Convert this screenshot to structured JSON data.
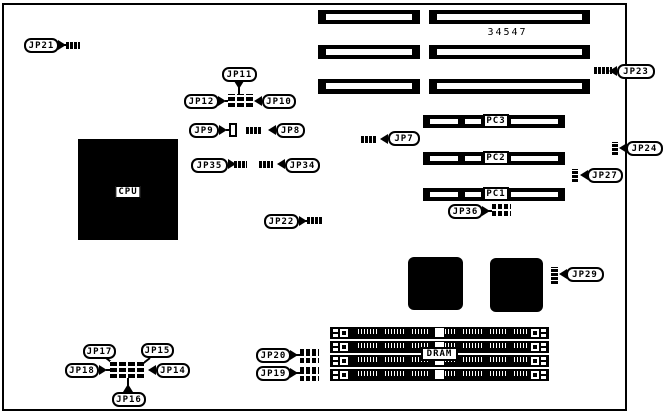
{
  "board_number": "34547",
  "cpu": {
    "label": "CPU"
  },
  "dram": {
    "label": "DRAM"
  },
  "pci_slots": [
    {
      "label": "PC3"
    },
    {
      "label": "PC2"
    },
    {
      "label": "PC1"
    }
  ],
  "jumpers": {
    "jp7": "JP7",
    "jp8": "JP8",
    "jp9": "JP9",
    "jp10": "JP10",
    "jp11": "JP11",
    "jp12": "JP12",
    "jp14": "JP14",
    "jp15": "JP15",
    "jp16": "JP16",
    "jp17": "JP17",
    "jp18": "JP18",
    "jp19": "JP19",
    "jp20": "JP20",
    "jp21": "JP21",
    "jp22": "JP22",
    "jp23": "JP23",
    "jp24": "JP24",
    "jp27": "JP27",
    "jp29": "JP29",
    "jp34": "JP34",
    "jp35": "JP35",
    "jp36": "JP36"
  },
  "colors": {
    "line": "#000000",
    "background": "#ffffff"
  }
}
